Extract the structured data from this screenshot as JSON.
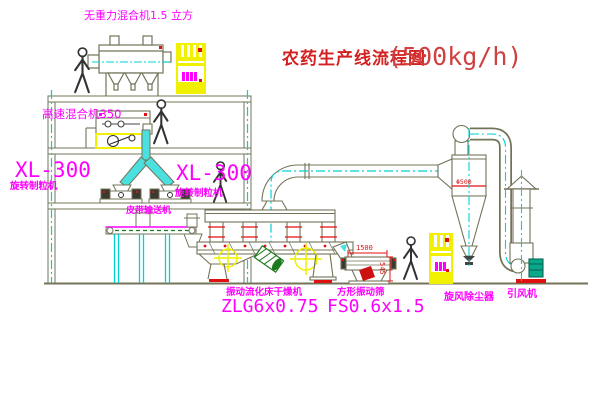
{
  "title": {
    "text": "农药生产线流程图",
    "capacity": "(500kg/h)"
  },
  "equipment": {
    "gravity_mixer": {
      "label": "无重力混合机1.5 立方"
    },
    "high_speed_mixer": {
      "label": "高速混合机350"
    },
    "granulator_left": {
      "model": "XL-300",
      "name": "旋转制粒机"
    },
    "granulator_right": {
      "model": "XL-300",
      "name": "旋转制粒机"
    },
    "belt_conveyor": {
      "label": "皮带输送机"
    },
    "dryer": {
      "name": "振动流化床干燥机",
      "model": "ZLG6x0.75"
    },
    "screen": {
      "name": "方形振动筛",
      "model": "FS0.6x1.5"
    },
    "cyclone": {
      "name": "旋风除尘器"
    },
    "fan": {
      "name": "引风机"
    }
  },
  "dimensions": {
    "screen_length": "1500",
    "screen_height": "545",
    "cyclone": "Φ500"
  },
  "colors": {
    "line_olive": "#73735a",
    "accent_yellow": "#f0f000",
    "centerline_cyan": "#00d2d2",
    "material_cyan": "#4ae0e0",
    "label_magenta": "#ff00ff",
    "title_red": "#cc2222",
    "dimension_red": "#e01010",
    "hatch_green": "#1e7a1e"
  }
}
